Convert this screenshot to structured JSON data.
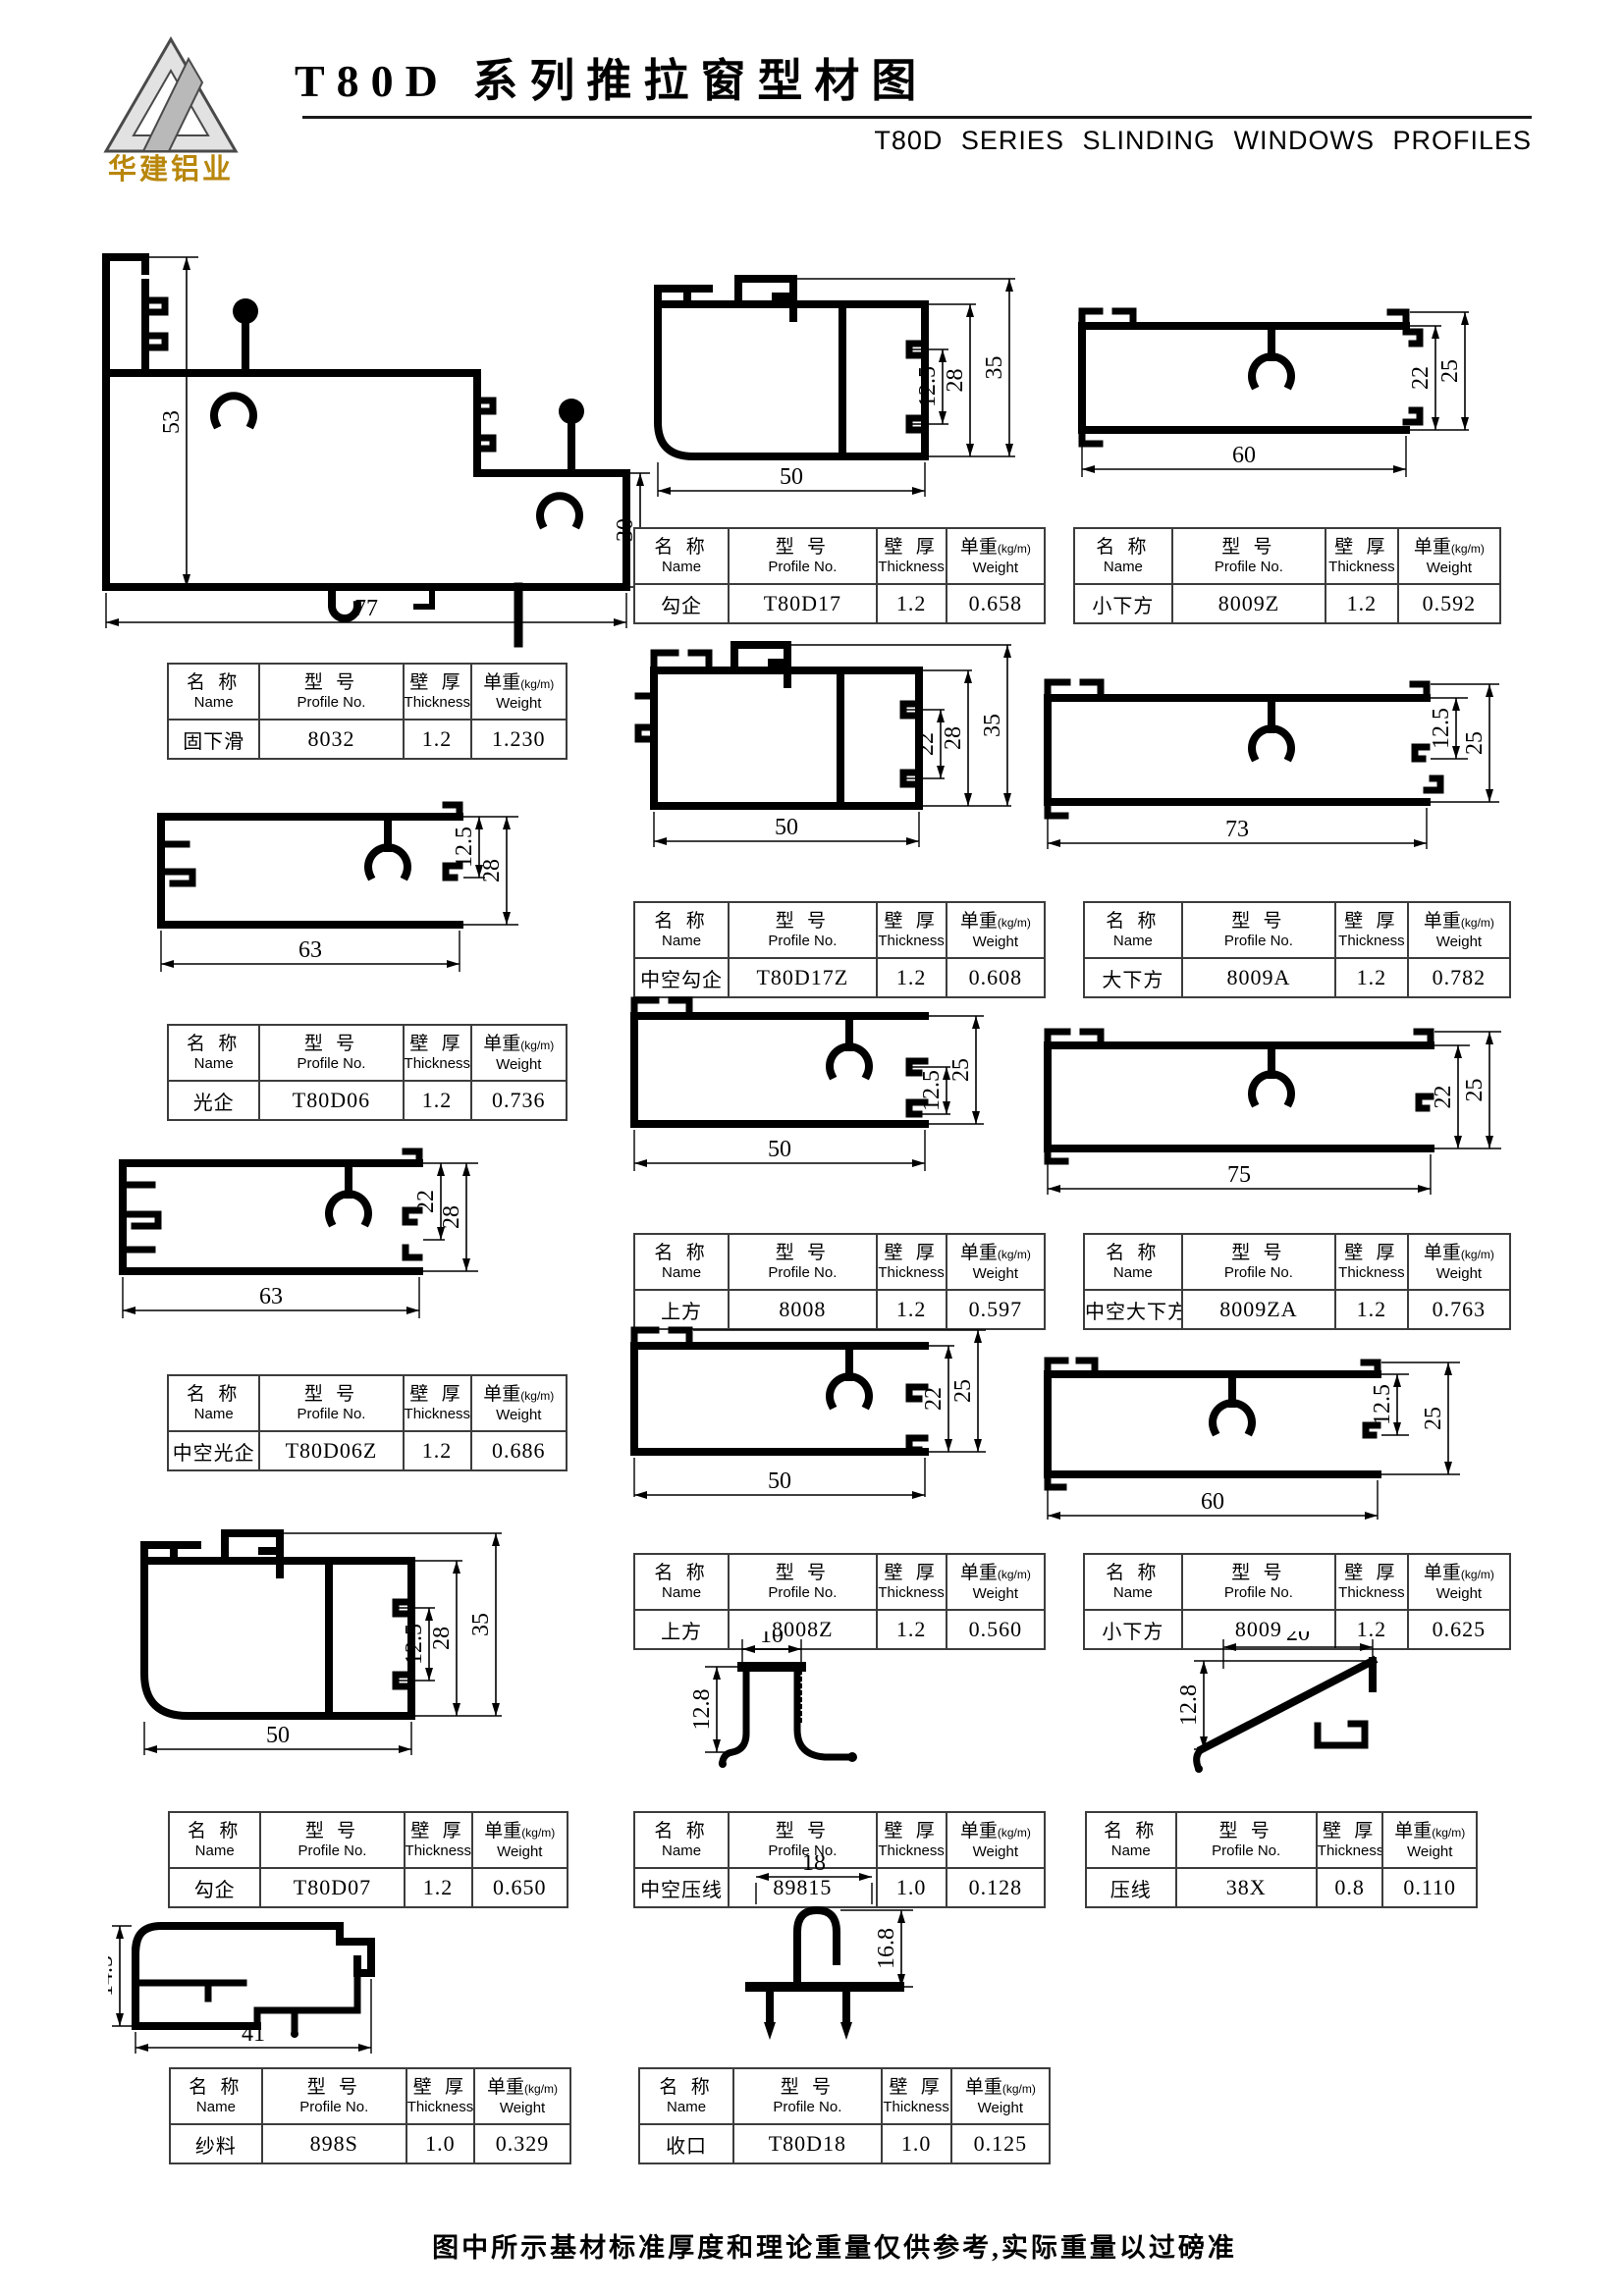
{
  "header": {
    "logo_text": "华建铝业",
    "title": "T80D 系列推拉窗型材图",
    "subtitle": "T80D SERIES SLINDING WINDOWS PROFILES"
  },
  "table_headers": {
    "name_cn": "名 称",
    "name_en": "Name",
    "model_cn": "型 号",
    "model_en": "Profile No.",
    "thickness_cn": "壁 厚",
    "thickness_en": "Thickness",
    "weight_cn": "单重",
    "weight_unit": "(kg/m)",
    "weight_en": "Weight"
  },
  "profiles": [
    {
      "name": "固下滑",
      "model": "8032",
      "thickness": "1.2",
      "weight": "1.230",
      "dims": [
        "53",
        "30",
        "77"
      ]
    },
    {
      "name": "勾企",
      "model": "T80D17",
      "thickness": "1.2",
      "weight": "0.658",
      "dims": [
        "12.5",
        "28",
        "35",
        "50"
      ]
    },
    {
      "name": "小下方",
      "model": "8009Z",
      "thickness": "1.2",
      "weight": "0.592",
      "dims": [
        "22",
        "25",
        "60"
      ]
    },
    {
      "name": "光企",
      "model": "T80D06",
      "thickness": "1.2",
      "weight": "0.736",
      "dims": [
        "12.5",
        "28",
        "63"
      ]
    },
    {
      "name": "中空勾企",
      "model": "T80D17Z",
      "thickness": "1.2",
      "weight": "0.608",
      "dims": [
        "22",
        "28",
        "35",
        "50"
      ]
    },
    {
      "name": "大下方",
      "model": "8009A",
      "thickness": "1.2",
      "weight": "0.782",
      "dims": [
        "12.5",
        "25",
        "73"
      ]
    },
    {
      "name": "中空光企",
      "model": "T80D06Z",
      "thickness": "1.2",
      "weight": "0.686",
      "dims": [
        "22",
        "28",
        "63"
      ]
    },
    {
      "name": "上方",
      "model": "8008",
      "thickness": "1.2",
      "weight": "0.597",
      "dims": [
        "12.5",
        "25",
        "50"
      ]
    },
    {
      "name": "中空大下方",
      "model": "8009ZA",
      "thickness": "1.2",
      "weight": "0.763",
      "dims": [
        "22",
        "25",
        "75"
      ]
    },
    {
      "name": "勾企",
      "model": "T80D07",
      "thickness": "1.2",
      "weight": "0.650",
      "dims": [
        "12.5",
        "28",
        "35",
        "50"
      ]
    },
    {
      "name": "上方",
      "model": "8008Z",
      "thickness": "1.2",
      "weight": "0.560",
      "dims": [
        "22",
        "25",
        "50"
      ]
    },
    {
      "name": "小下方",
      "model": "8009",
      "thickness": "1.2",
      "weight": "0.625",
      "dims": [
        "12.5",
        "25",
        "60"
      ]
    },
    {
      "name": "中空压线",
      "model": "89815",
      "thickness": "1.0",
      "weight": "0.128",
      "dims": [
        "10",
        "12.8"
      ]
    },
    {
      "name": "压线",
      "model": "38X",
      "thickness": "0.8",
      "weight": "0.110",
      "dims": [
        "20",
        "12.8"
      ]
    },
    {
      "name": "纱料",
      "model": "898S",
      "thickness": "1.0",
      "weight": "0.329",
      "dims": [
        "14.5",
        "41"
      ]
    },
    {
      "name": "收口",
      "model": "T80D18",
      "thickness": "1.0",
      "weight": "0.125",
      "dims": [
        "18",
        "16.8"
      ]
    }
  ],
  "footer": {
    "note": "图中所示基材标准厚度和理论重量仅供参考,实际重量以过磅准"
  }
}
